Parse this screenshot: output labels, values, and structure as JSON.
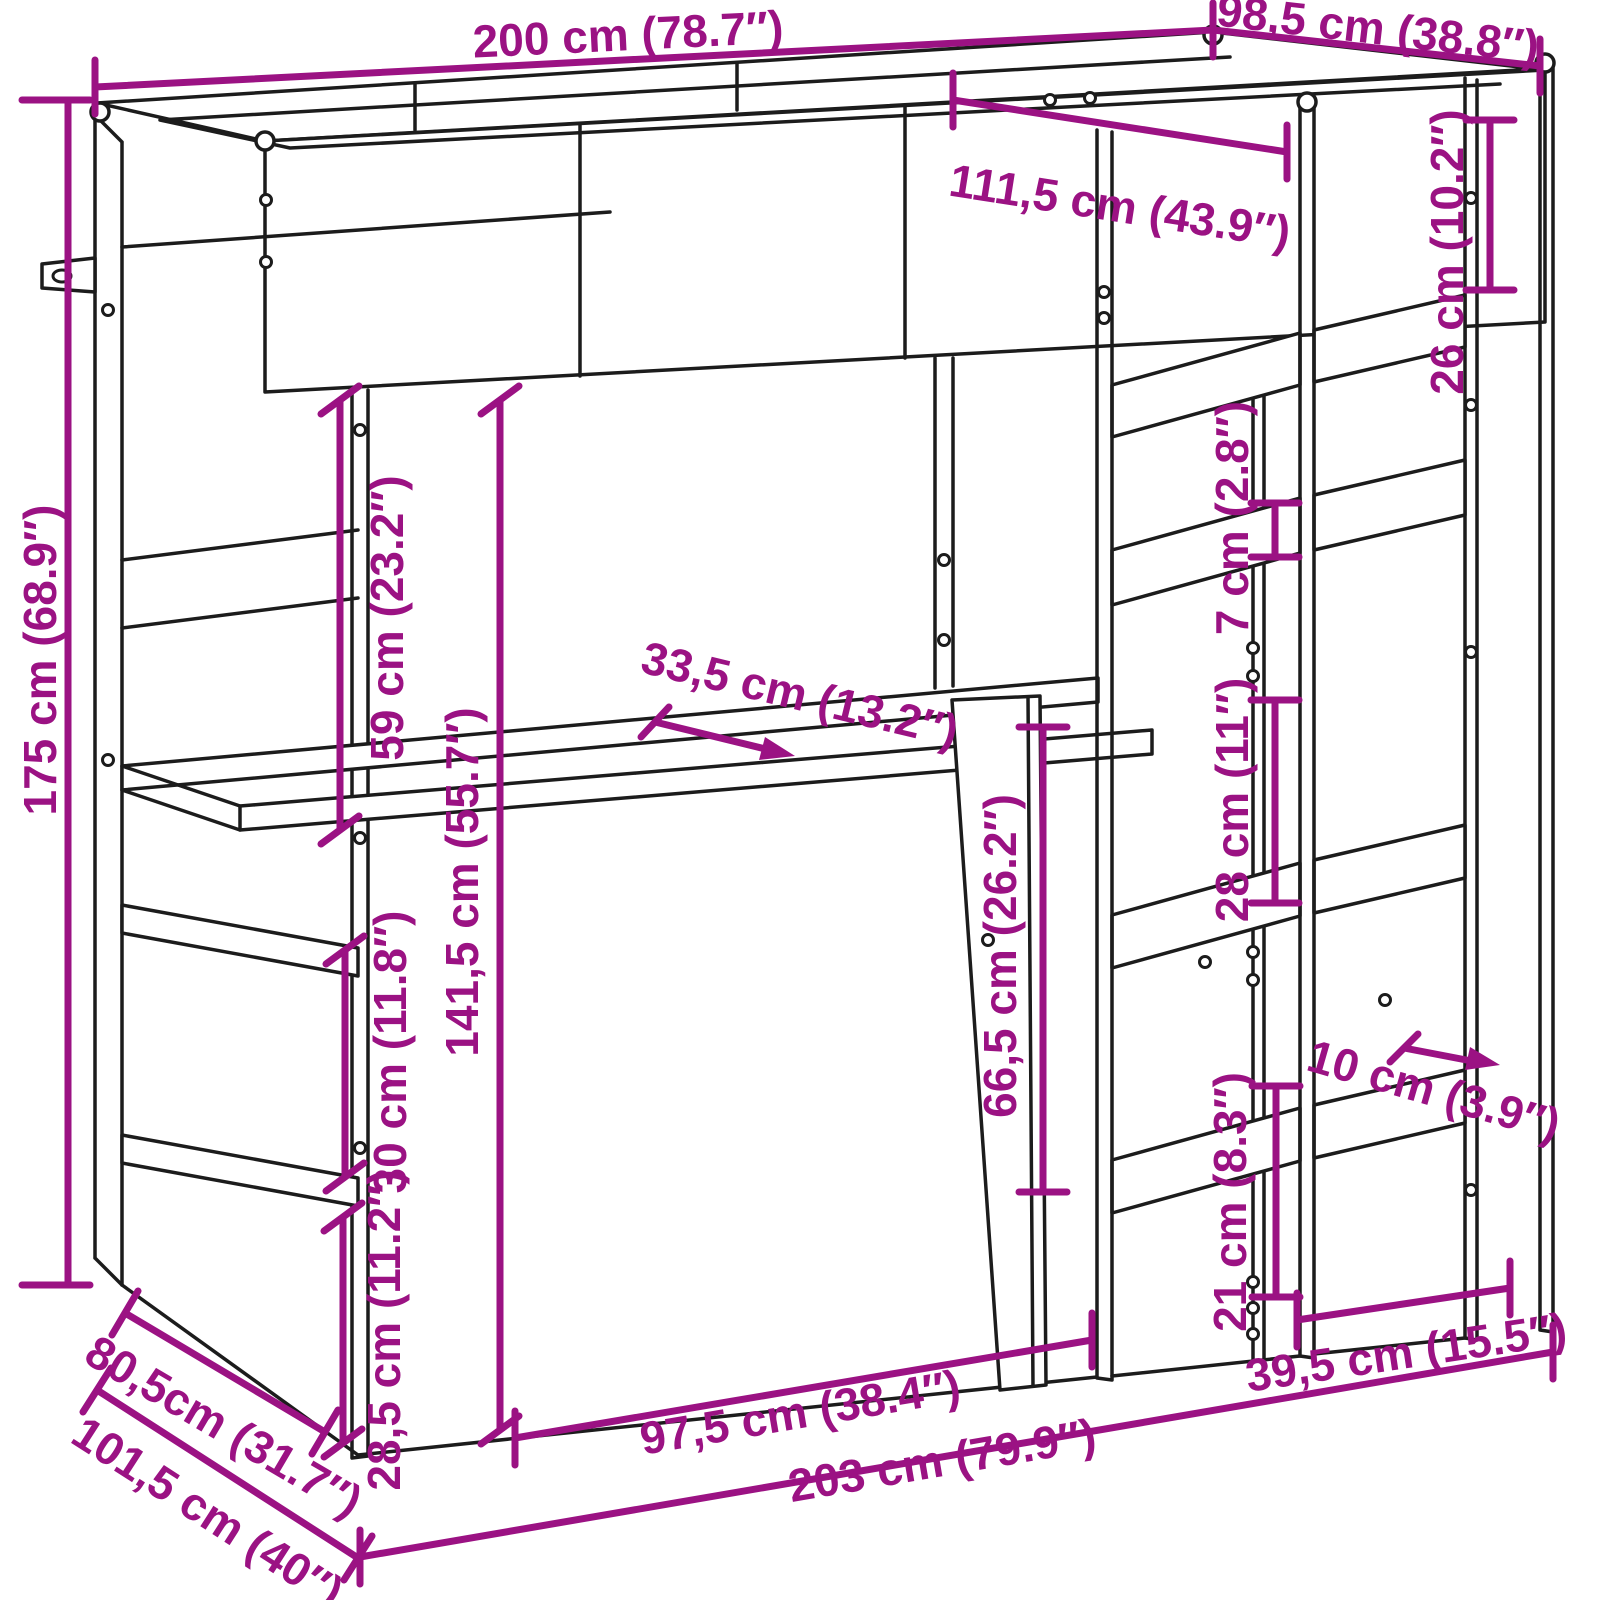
{
  "diagram": {
    "subject": "loft-bed-with-desk-and-shelf-tower-dimension-drawing",
    "background_color": "#ffffff",
    "drawing_line_color": "#1c1c1c",
    "accent_color": "#9B1283",
    "dimensions": [
      {
        "id": "total-length-top",
        "label": "200 cm (78.7″)",
        "cm": "200",
        "inches": "78.7"
      },
      {
        "id": "top-depth",
        "label": "98,5 cm (38.8″)",
        "cm": "98,5",
        "inches": "38.8"
      },
      {
        "id": "upper-inner-depth",
        "label": "111,5 cm (43.9″)",
        "cm": "111,5",
        "inches": "43.9"
      },
      {
        "id": "tower-top-gap",
        "label": "26 cm (10.2″)",
        "cm": "26",
        "inches": "10.2"
      },
      {
        "id": "shelf-board-thickness",
        "label": "7 cm (2.8″)",
        "cm": "7",
        "inches": "2.8"
      },
      {
        "id": "shelf-gap-upper",
        "label": "28 cm (11″)",
        "cm": "28",
        "inches": "11"
      },
      {
        "id": "total-height",
        "label": "175 cm (68.9″)",
        "cm": "175",
        "inches": "68.9"
      },
      {
        "id": "bed-frame-to-desk",
        "label": "59 cm (23.2″)",
        "cm": "59",
        "inches": "23.2"
      },
      {
        "id": "under-bed-height",
        "label": "141,5 cm (55.7″)",
        "cm": "141,5",
        "inches": "55.7"
      },
      {
        "id": "desk-depth",
        "label": "33,5 cm (13.2″)",
        "cm": "33,5",
        "inches": "13.2"
      },
      {
        "id": "desk-clearance-height",
        "label": "66,5 cm (26.2″)",
        "cm": "66,5",
        "inches": "26.2"
      },
      {
        "id": "left-shelf-gap",
        "label": "30 cm (11.8″)",
        "cm": "30",
        "inches": "11.8"
      },
      {
        "id": "left-shelf-bottom-gap",
        "label": "28,5 cm (11.2″)",
        "cm": "28,5",
        "inches": "11.2"
      },
      {
        "id": "left-end-depth-upper",
        "label": "80,5cm (31.7″)",
        "cm": "80,5",
        "inches": "31.7"
      },
      {
        "id": "left-end-depth-floor",
        "label": "101,5 cm (40″)",
        "cm": "101,5",
        "inches": "40"
      },
      {
        "id": "desk-width",
        "label": "97,5 cm (38.4″)",
        "cm": "97,5",
        "inches": "38.4"
      },
      {
        "id": "total-length-floor",
        "label": "203 cm (79.9″)",
        "cm": "203",
        "inches": "79.9"
      },
      {
        "id": "tower-base-width",
        "label": "39,5 cm (15.5″)",
        "cm": "39,5",
        "inches": "15.5"
      },
      {
        "id": "tower-bottom-gap",
        "label": "21 cm (8.3″)",
        "cm": "21",
        "inches": "8.3"
      },
      {
        "id": "shelf-board-depth",
        "label": "10 cm (3.9″)",
        "cm": "10",
        "inches": "3.9"
      }
    ]
  }
}
